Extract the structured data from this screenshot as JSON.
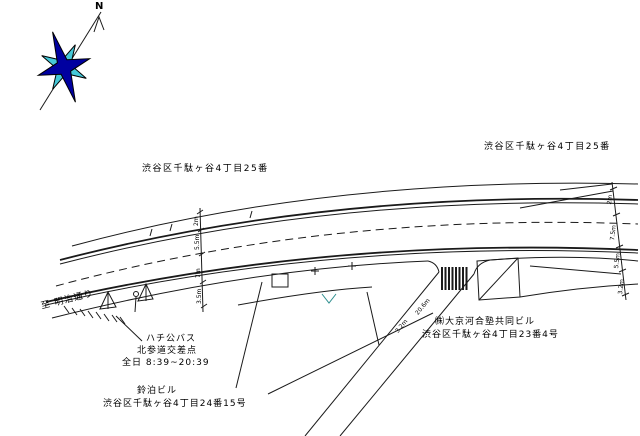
{
  "compass": {
    "label": "N"
  },
  "blocks": {
    "left": "渋谷区千駄ヶ谷4丁目25番",
    "right": "渋谷区千駄ヶ谷4丁目25番"
  },
  "streets": {
    "to_meiji_dori": "至 明治通り"
  },
  "bus_stop": {
    "line1": "ハチ公バス",
    "line2": "北参道交差点",
    "line3": "全日 8:39~20:39"
  },
  "building_sw": {
    "name": "鈴泊ビル",
    "address": "渋谷区千駄ヶ谷4丁目24番15号"
  },
  "building_se": {
    "name": "㈱大京河合塾共同ビル",
    "address": "渋谷区千駄ヶ谷4丁目23番4号"
  },
  "dims": {
    "mid": [
      "2m",
      "5.5m",
      "7m",
      "3.5m"
    ],
    "right": [
      "2m",
      "7.5m",
      "5.5m",
      "3.2m"
    ],
    "side_road": [
      "20.6m",
      "3.2m"
    ]
  },
  "colors": {
    "line": "#1a1a1a",
    "compass_navy": "#0000A0",
    "compass_cyan": "#45C8D8",
    "notch_teal": "#2F8F8F"
  }
}
